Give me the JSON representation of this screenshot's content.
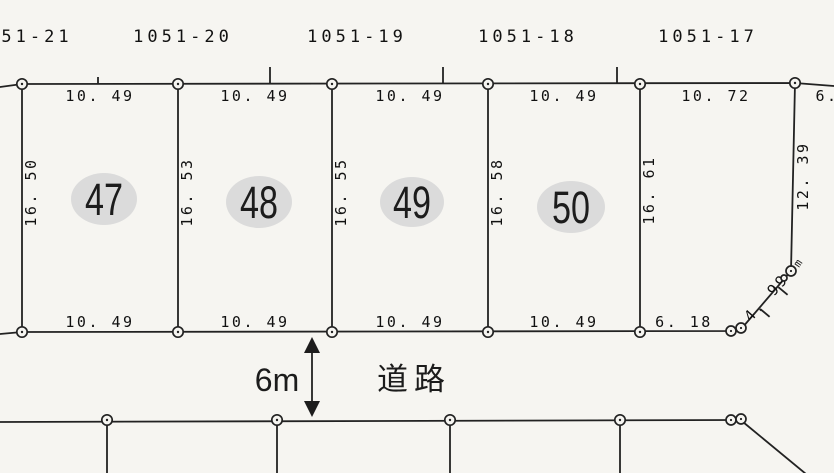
{
  "map": {
    "parcel_labels": [
      "51-21",
      "1051-20",
      "1051-19",
      "1051-18",
      "1051-17"
    ],
    "top_measurements": [
      "10. 49",
      "10. 49",
      "10. 49",
      "10. 49",
      "10. 72",
      "6."
    ],
    "depth_measurements": [
      "16. 50",
      "16. 53",
      "16. 55",
      "16. 58",
      "16. 61"
    ],
    "right_edge": {
      "vertical_measurement": "12. 39",
      "diagonal_measurement": "4. 99",
      "junction_mark": "m"
    },
    "bottom_measurements": [
      "10. 49",
      "10. 49",
      "10. 49",
      "10. 49",
      "6. 18"
    ],
    "plot_numbers": [
      "47",
      "48",
      "49",
      "50"
    ],
    "road": {
      "width_label": "6m",
      "name_label": "道路"
    },
    "colors": {
      "line": "#222222",
      "text": "#111111",
      "plot_ellipse_fill": "#dbdbdb",
      "background": "#f6f5f1"
    }
  }
}
